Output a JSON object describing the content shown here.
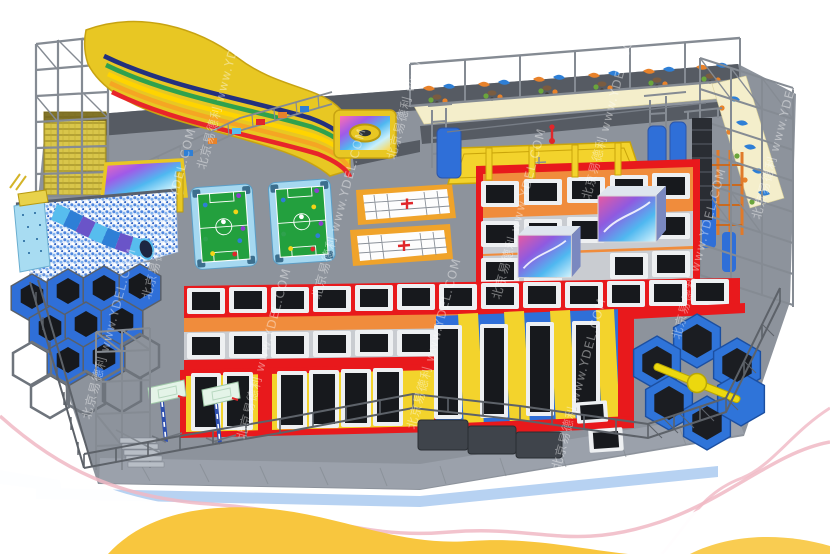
{
  "scene": {
    "type": "3d-render",
    "subject": "indoor trampoline park design render",
    "background_color": "#ffffff"
  },
  "watermark": {
    "text": "北京易德利 www.YDEL.COM",
    "company_cn": "北京易德利",
    "website": "www.YDEL.COM",
    "color": "#ffffff",
    "opacity": 0.42,
    "rotation_deg": -75
  },
  "palette": {
    "frame_red": "#e8191c",
    "pad_orange": "#f08c3c",
    "pad_yellow": "#f3d32c",
    "pad_blue": "#2f6fd8",
    "table_green": "#23a03e",
    "trampoline_black": "#17191d",
    "floor_gray": "#8d939c",
    "floor_dark": "#565b63",
    "walkway_gray": "#9ba1ab",
    "slide_yellow": "#e8c723",
    "seating_cream": "#f4eecb",
    "table_blue_border": "#a5d8f0",
    "steel_gray": "#858b93",
    "fence_gray": "#5d6269",
    "ballpit_blue": "#5b8fe0",
    "wave_yellow": "#f8c63e",
    "wave_pink": "#f0b8c4",
    "edge_band_blue": "#b7d2f2",
    "watermark_color": "#ffffff"
  },
  "features": {
    "names": [
      "rainbow-slide",
      "climbing-net-tower",
      "ball-pit",
      "tube-slide",
      "snookball-tables",
      "cross-courts",
      "zipline",
      "mezzanine-seating",
      "right-truss-seating",
      "free-jump-trampoline-grid",
      "graphic-airbag-cubes",
      "slam-dunk-lanes",
      "basketball-hoops",
      "lane-trampolines",
      "wipeout-hexagon-trampoline",
      "honeycomb-climber",
      "safety-fence",
      "steel-truss-frame",
      "decorative-waves"
    ]
  }
}
